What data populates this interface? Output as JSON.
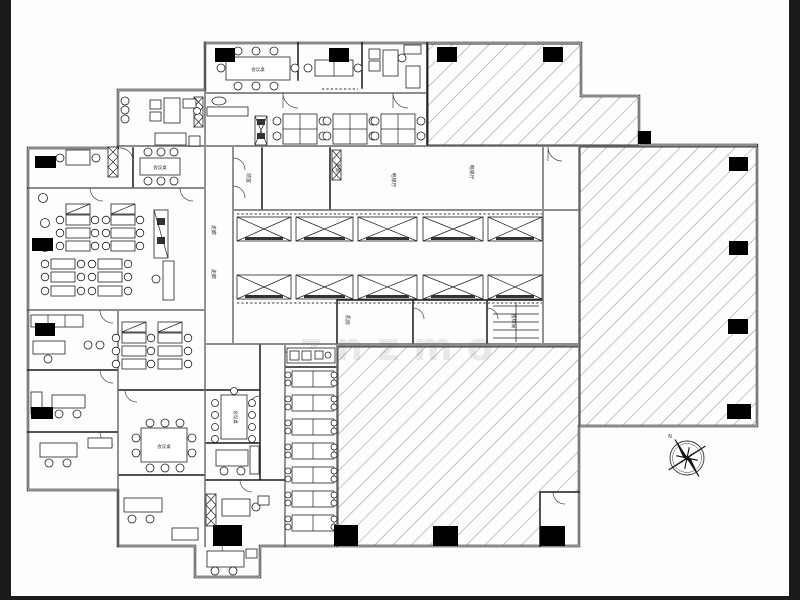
{
  "drawing": {
    "type": "office-floor-plan-cad",
    "labels": {
      "corridor_a": "走廊",
      "corridor_b": "走廊",
      "corridor_c": "走廊",
      "front_room": "前室",
      "elevator_hall_a": "电梯厅",
      "elevator_hall_b": "电梯厅",
      "machine_room": "机房",
      "stair_room": "楼梯间",
      "meeting_table_1": "会议桌",
      "meeting_table_2": "会议桌",
      "meeting_table_3": "会议桌",
      "meeting_table_4": "会议桌"
    },
    "watermark": "znzmo",
    "compass": {
      "north_label": "N"
    },
    "colors": {
      "frame_bar": "#1b1b1e",
      "paper": "#fdfdfd",
      "wall": "#141414",
      "hatch_line": "#6f6f6f",
      "column": "#000000",
      "watermark": "#dadada"
    }
  }
}
